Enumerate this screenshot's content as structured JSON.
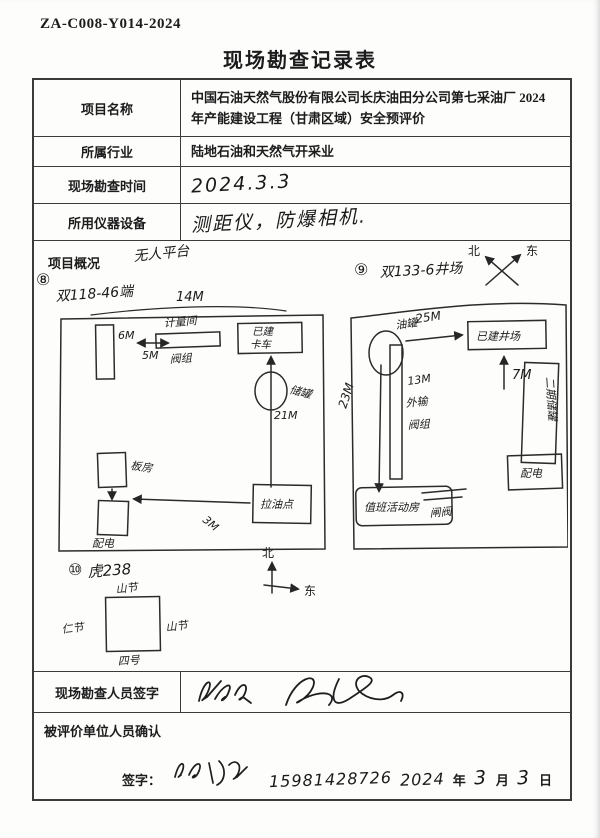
{
  "doc_number": "ZA-C008-Y014-2024",
  "title": "现场勘查记录表",
  "fields": {
    "project_name_label": "项目名称",
    "project_name": "中国石油天然气股份有限公司长庆油田分公司第七采油厂 2024 年产能建设工程（甘肃区域）安全预评价",
    "industry_label": "所属行业",
    "industry": "陆地石油和天然气开采业",
    "survey_time_label": "现场勘查时间",
    "survey_time": "2024.3.3",
    "instruments_label": "所用仪器设备",
    "instruments": "测距仪，防爆相机."
  },
  "overview": {
    "label": "项目概况",
    "top_note": "无人平台",
    "site1": {
      "num": "⑧",
      "name": "双118-46端",
      "dim_top": "14M",
      "tower_h": "6M",
      "gap": "5M",
      "bar_label_top": "计量间",
      "bar_label_bottom": "阀组",
      "box_right_line1": "已建",
      "box_right_line2": "卡车",
      "tank_label": "储罐",
      "tank_dim": "21M",
      "box_bottom_right": "拉油点",
      "box_left_top": "板房",
      "box_left_bottom": "配电",
      "bottom_dim": "3M"
    },
    "site2": {
      "num": "⑨",
      "name": "双133-6井场",
      "compass_n": "北",
      "compass_e": "东",
      "tank_label": "油罐",
      "dim_right": "25M",
      "box_top_right": "已建井场",
      "dim_7": "7M",
      "tall_box": "二期储罐",
      "dim_left": "23M",
      "pipe_labels": [
        "13M",
        "外输",
        "阀组"
      ],
      "valve_label": "闸阀",
      "box_bottom_left": "值班活动房",
      "box_bottom_right": "配电"
    },
    "site3": {
      "num": "⑩",
      "name": "虎238",
      "square_top": "山节",
      "square_left": "仁节",
      "square_right": "山节",
      "square_bottom": "四号",
      "compass_n": "北",
      "compass_e": "东"
    }
  },
  "surveyor_row": {
    "label": "现场勘查人员签字"
  },
  "confirm_row": {
    "label": "被评价单位人员确认",
    "sign_label": "签字：",
    "phone": "15981428726",
    "year_hw": "2024",
    "year": "年",
    "month_hw": "3",
    "month": "月",
    "day_hw": "3",
    "day": "日"
  }
}
